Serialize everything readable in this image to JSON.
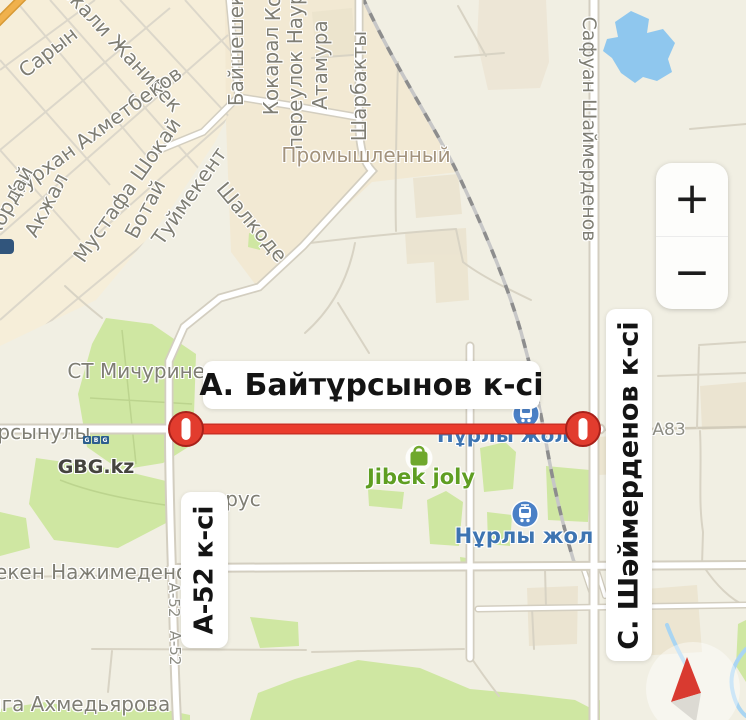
{
  "banners": {
    "baytursynov": {
      "text": "А. Байтұрсынов к-сі"
    },
    "shaymerdenov": {
      "text": "С. Шәймерденов к-сі"
    },
    "a52": {
      "text": "А-52 к-сі"
    }
  },
  "controls": {
    "zoom_in": "+",
    "zoom_out": "−"
  },
  "gbg_logo": {
    "letters": [
      "G",
      "B",
      "G"
    ]
  },
  "map_labels": [
    {
      "id": "saryn",
      "text": "Сарын",
      "x": 48,
      "y": 52,
      "rot": -38
    },
    {
      "id": "ekali-zhanibek",
      "text": "екали Жанибек",
      "x": 122,
      "y": 48,
      "rot": 47
    },
    {
      "id": "nurkhan-akhmetbekov",
      "text": "Нурхан Ахметбеков",
      "x": 95,
      "y": 132,
      "rot": -36
    },
    {
      "id": "korday",
      "text": "Кордай",
      "x": 9,
      "y": 202,
      "rot": -62
    },
    {
      "id": "akzhal",
      "text": "Акжал",
      "x": 46,
      "y": 205,
      "rot": -62
    },
    {
      "id": "mustafa-shokay",
      "text": "Мустафа Шокай",
      "x": 127,
      "y": 190,
      "rot": -55
    },
    {
      "id": "botay",
      "text": "Ботай",
      "x": 145,
      "y": 209,
      "rot": -62
    },
    {
      "id": "tuymekent",
      "text": "Туймекент",
      "x": 189,
      "y": 196,
      "rot": -55
    },
    {
      "id": "shalkode",
      "text": "Шалкоде",
      "x": 252,
      "y": 222,
      "rot": 50
    },
    {
      "id": "bayshehek",
      "text": "Байшешек",
      "x": 236,
      "y": 50,
      "rot": -90
    },
    {
      "id": "ko-partial",
      "text": "Ко",
      "x": 273,
      "y": 8,
      "rot": -90
    },
    {
      "id": "kokaral",
      "text": "Кокарал",
      "x": 271,
      "y": 71,
      "rot": -90
    },
    {
      "id": "pereulok-nauryz",
      "text": "переулок Наурыз",
      "x": 295,
      "y": 58,
      "rot": -90
    },
    {
      "id": "atamura",
      "text": "Атамура",
      "x": 320,
      "y": 65,
      "rot": -90
    },
    {
      "id": "sharbakty",
      "text": "Шарбакты",
      "x": 359,
      "y": 86,
      "rot": -90
    },
    {
      "id": "promyshlenny",
      "text": "Промышленный",
      "x": 366,
      "y": 155,
      "rot": 0,
      "color": "#a3937d"
    },
    {
      "id": "safuan-shaymerdenov",
      "text": "Сафуан Шаймерденов",
      "x": 589,
      "y": 129,
      "rot": 90,
      "size": 19
    },
    {
      "id": "st-michurinets",
      "text": "СТ Мичуринец",
      "x": 143,
      "y": 371,
      "rot": 0
    },
    {
      "id": "ursynuly",
      "text": "урсынулы",
      "x": 38,
      "y": 432,
      "rot": 0
    },
    {
      "id": "rus",
      "text": "рус",
      "x": 243,
      "y": 499,
      "rot": 0
    },
    {
      "id": "meken-nazhimedenov",
      "text": "мекен Нажимеденов",
      "x": 90,
      "y": 572,
      "rot": 0
    },
    {
      "id": "a52-road-1",
      "text": "А-52",
      "x": 174,
      "y": 600,
      "rot": 90,
      "size": 15,
      "color": "#8d8d84"
    },
    {
      "id": "a52-road-2",
      "text": "А-52",
      "x": 175,
      "y": 648,
      "rot": 90,
      "size": 15,
      "color": "#8d8d84"
    },
    {
      "id": "yga-akhmedyarova",
      "text": "ыга Ахмедьярова",
      "x": 78,
      "y": 704,
      "rot": 0
    },
    {
      "id": "a83",
      "text": "А83",
      "x": 669,
      "y": 430,
      "rot": 0,
      "size": 17,
      "color": "#8d8d84"
    },
    {
      "id": "gbg-kz",
      "text": "GBG.kz",
      "x": 96,
      "y": 467,
      "rot": 0,
      "size": 19,
      "color": "#45443e",
      "weight": 700
    },
    {
      "id": "jibek-joly",
      "text": "Jibek joly",
      "x": 421,
      "y": 477,
      "rot": 0,
      "size": 21,
      "color": "#5f9e22",
      "weight": 600
    },
    {
      "id": "nurly-zhol-1",
      "text": "Нұрлы жол",
      "x": 503,
      "y": 435,
      "rot": 0,
      "size": 20,
      "color": "#3d74b2",
      "weight": 600
    },
    {
      "id": "nurly-zhol-2",
      "text": "Нұрлы жол",
      "x": 524,
      "y": 536,
      "rot": 0,
      "size": 21,
      "color": "#3d74b2",
      "weight": 600
    }
  ],
  "icons": {
    "closure": "no-entry-icon",
    "metro": "train-station-icon",
    "jibek": "shopping-bag-icon",
    "compass": "compass-needle-icon",
    "zoom_in": "plus-icon",
    "zoom_out": "minus-icon"
  },
  "colors": {
    "closure_red": "#ea3b2c",
    "closure_ring": "#a8211a",
    "water": "#8fc7ee",
    "park": "#cfe7a2",
    "urban": "#f6eed9",
    "industrial": "#f2e7d0",
    "background": "#f1efe3",
    "poi_blue": "#4a80c6",
    "poi_green": "#6fa82d",
    "label_gray": "#7f7e74"
  }
}
